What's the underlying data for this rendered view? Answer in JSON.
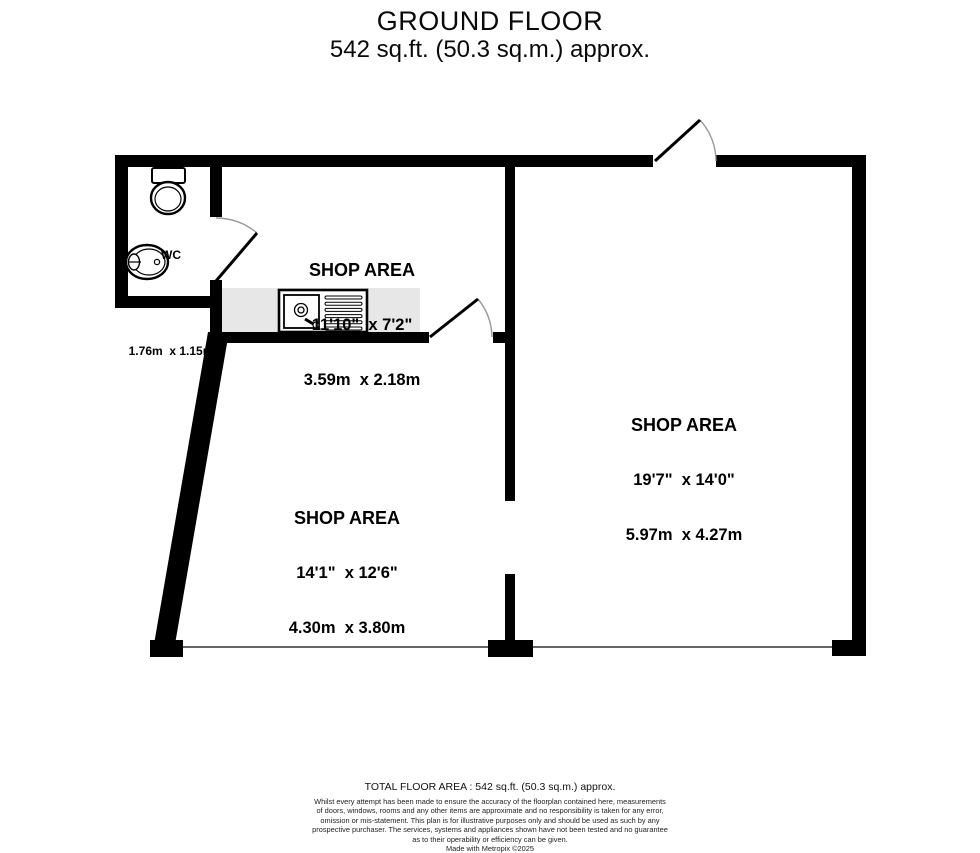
{
  "title": {
    "line1": "GROUND FLOOR",
    "line2": "542 sq.ft. (50.3 sq.m.) approx."
  },
  "rooms": {
    "wc": {
      "name": "WC",
      "imperial": "5'9\"  x 3'9\"",
      "metric": "1.76m  x 1.15m"
    },
    "shop_top": {
      "name": "SHOP AREA",
      "imperial": "11'10\"  x 7'2\"",
      "metric": "3.59m  x 2.18m"
    },
    "shop_right": {
      "name": "SHOP AREA",
      "imperial": "19'7\"  x 14'0\"",
      "metric": "5.97m  x 4.27m"
    },
    "shop_left": {
      "name": "SHOP AREA",
      "imperial": "14'1\"  x 12'6\"",
      "metric": "4.30m  x 3.80m"
    }
  },
  "footer": {
    "total": "TOTAL FLOOR AREA : 542 sq.ft. (50.3 sq.m.) approx.",
    "disclaimer_lines": [
      "Whilst every attempt has been made to ensure the accuracy of the floorplan contained here, measurements",
      "of doors, windows, rooms and any other items are approximate and no responsibility is taken for any error,",
      "omission or mis-statement. This plan is for illustrative purposes only and should be used as such by any",
      "prospective purchaser. The services, systems and appliances shown have not been tested and no guarantee",
      "as to their operability or efficiency can be given."
    ],
    "credit": "Made with Metropix ©2025"
  },
  "colors": {
    "wall": "#000000",
    "counter_fill": "#e7e7e7",
    "door_arc": "#999999",
    "front_line": "#666666"
  }
}
